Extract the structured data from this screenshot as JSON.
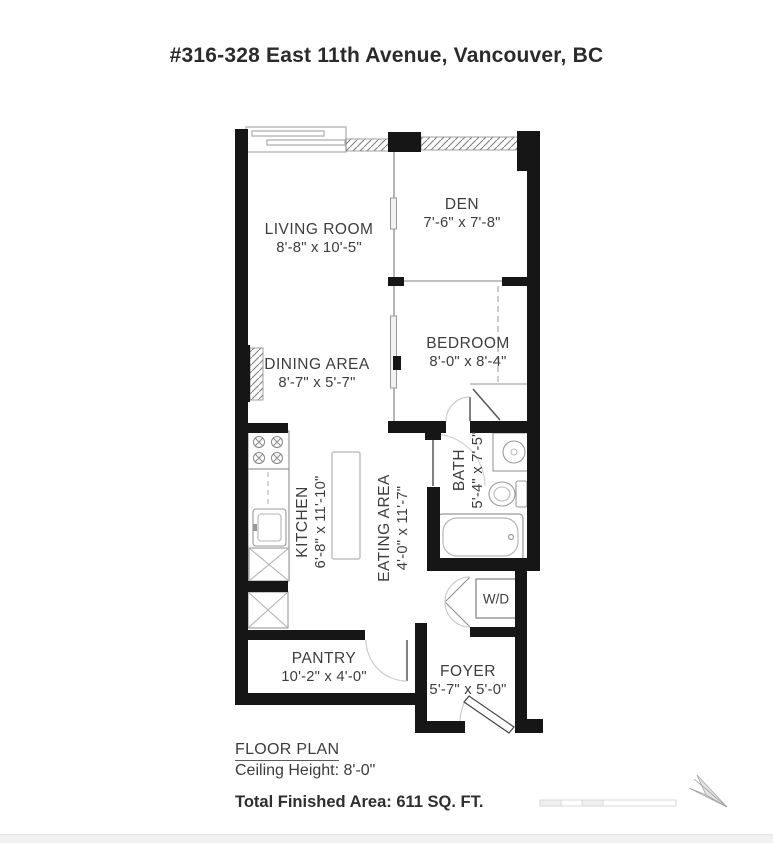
{
  "title": "#316-328 East 11th Avenue, Vancouver, BC",
  "rooms": {
    "living": {
      "name": "LIVING ROOM",
      "dims": "8'-8\" x 10'-5\""
    },
    "den": {
      "name": "DEN",
      "dims": "7'-6\" x 7'-8\""
    },
    "bedroom": {
      "name": "BEDROOM",
      "dims": "8'-0\" x 8'-4\""
    },
    "dining": {
      "name": "DINING AREA",
      "dims": "8'-7\" x 5'-7\""
    },
    "kitchen": {
      "name": "KITCHEN",
      "dims": "6'-8\" x 11'-10\""
    },
    "eating": {
      "name": "EATING AREA",
      "dims": "4'-0\" x 11'-7\""
    },
    "bath": {
      "name": "BATH",
      "dims": "5'-4\" x 7'-5\""
    },
    "wd": {
      "name": "W/D"
    },
    "pantry": {
      "name": "PANTRY",
      "dims": "10'-2\" x 4'-0\""
    },
    "foyer": {
      "name": "FOYER",
      "dims": "5'-7\" x 5'-0\""
    }
  },
  "footer": {
    "plan_label": "FLOOR PLAN",
    "ceiling_height": "Ceiling Height: 8'-0\"",
    "total_area": "Total Finished Area: 611 SQ. FT."
  },
  "icons": {
    "north_arrow": "north-arrow-icon",
    "scale_bar": "scale-bar-icon"
  },
  "colors": {
    "wall": "#161616",
    "text": "#3d3d3d",
    "fixture_stroke": "#999999",
    "door_arc": "#cccccc",
    "faint": "#e0e0e0",
    "background": "#ffffff"
  }
}
